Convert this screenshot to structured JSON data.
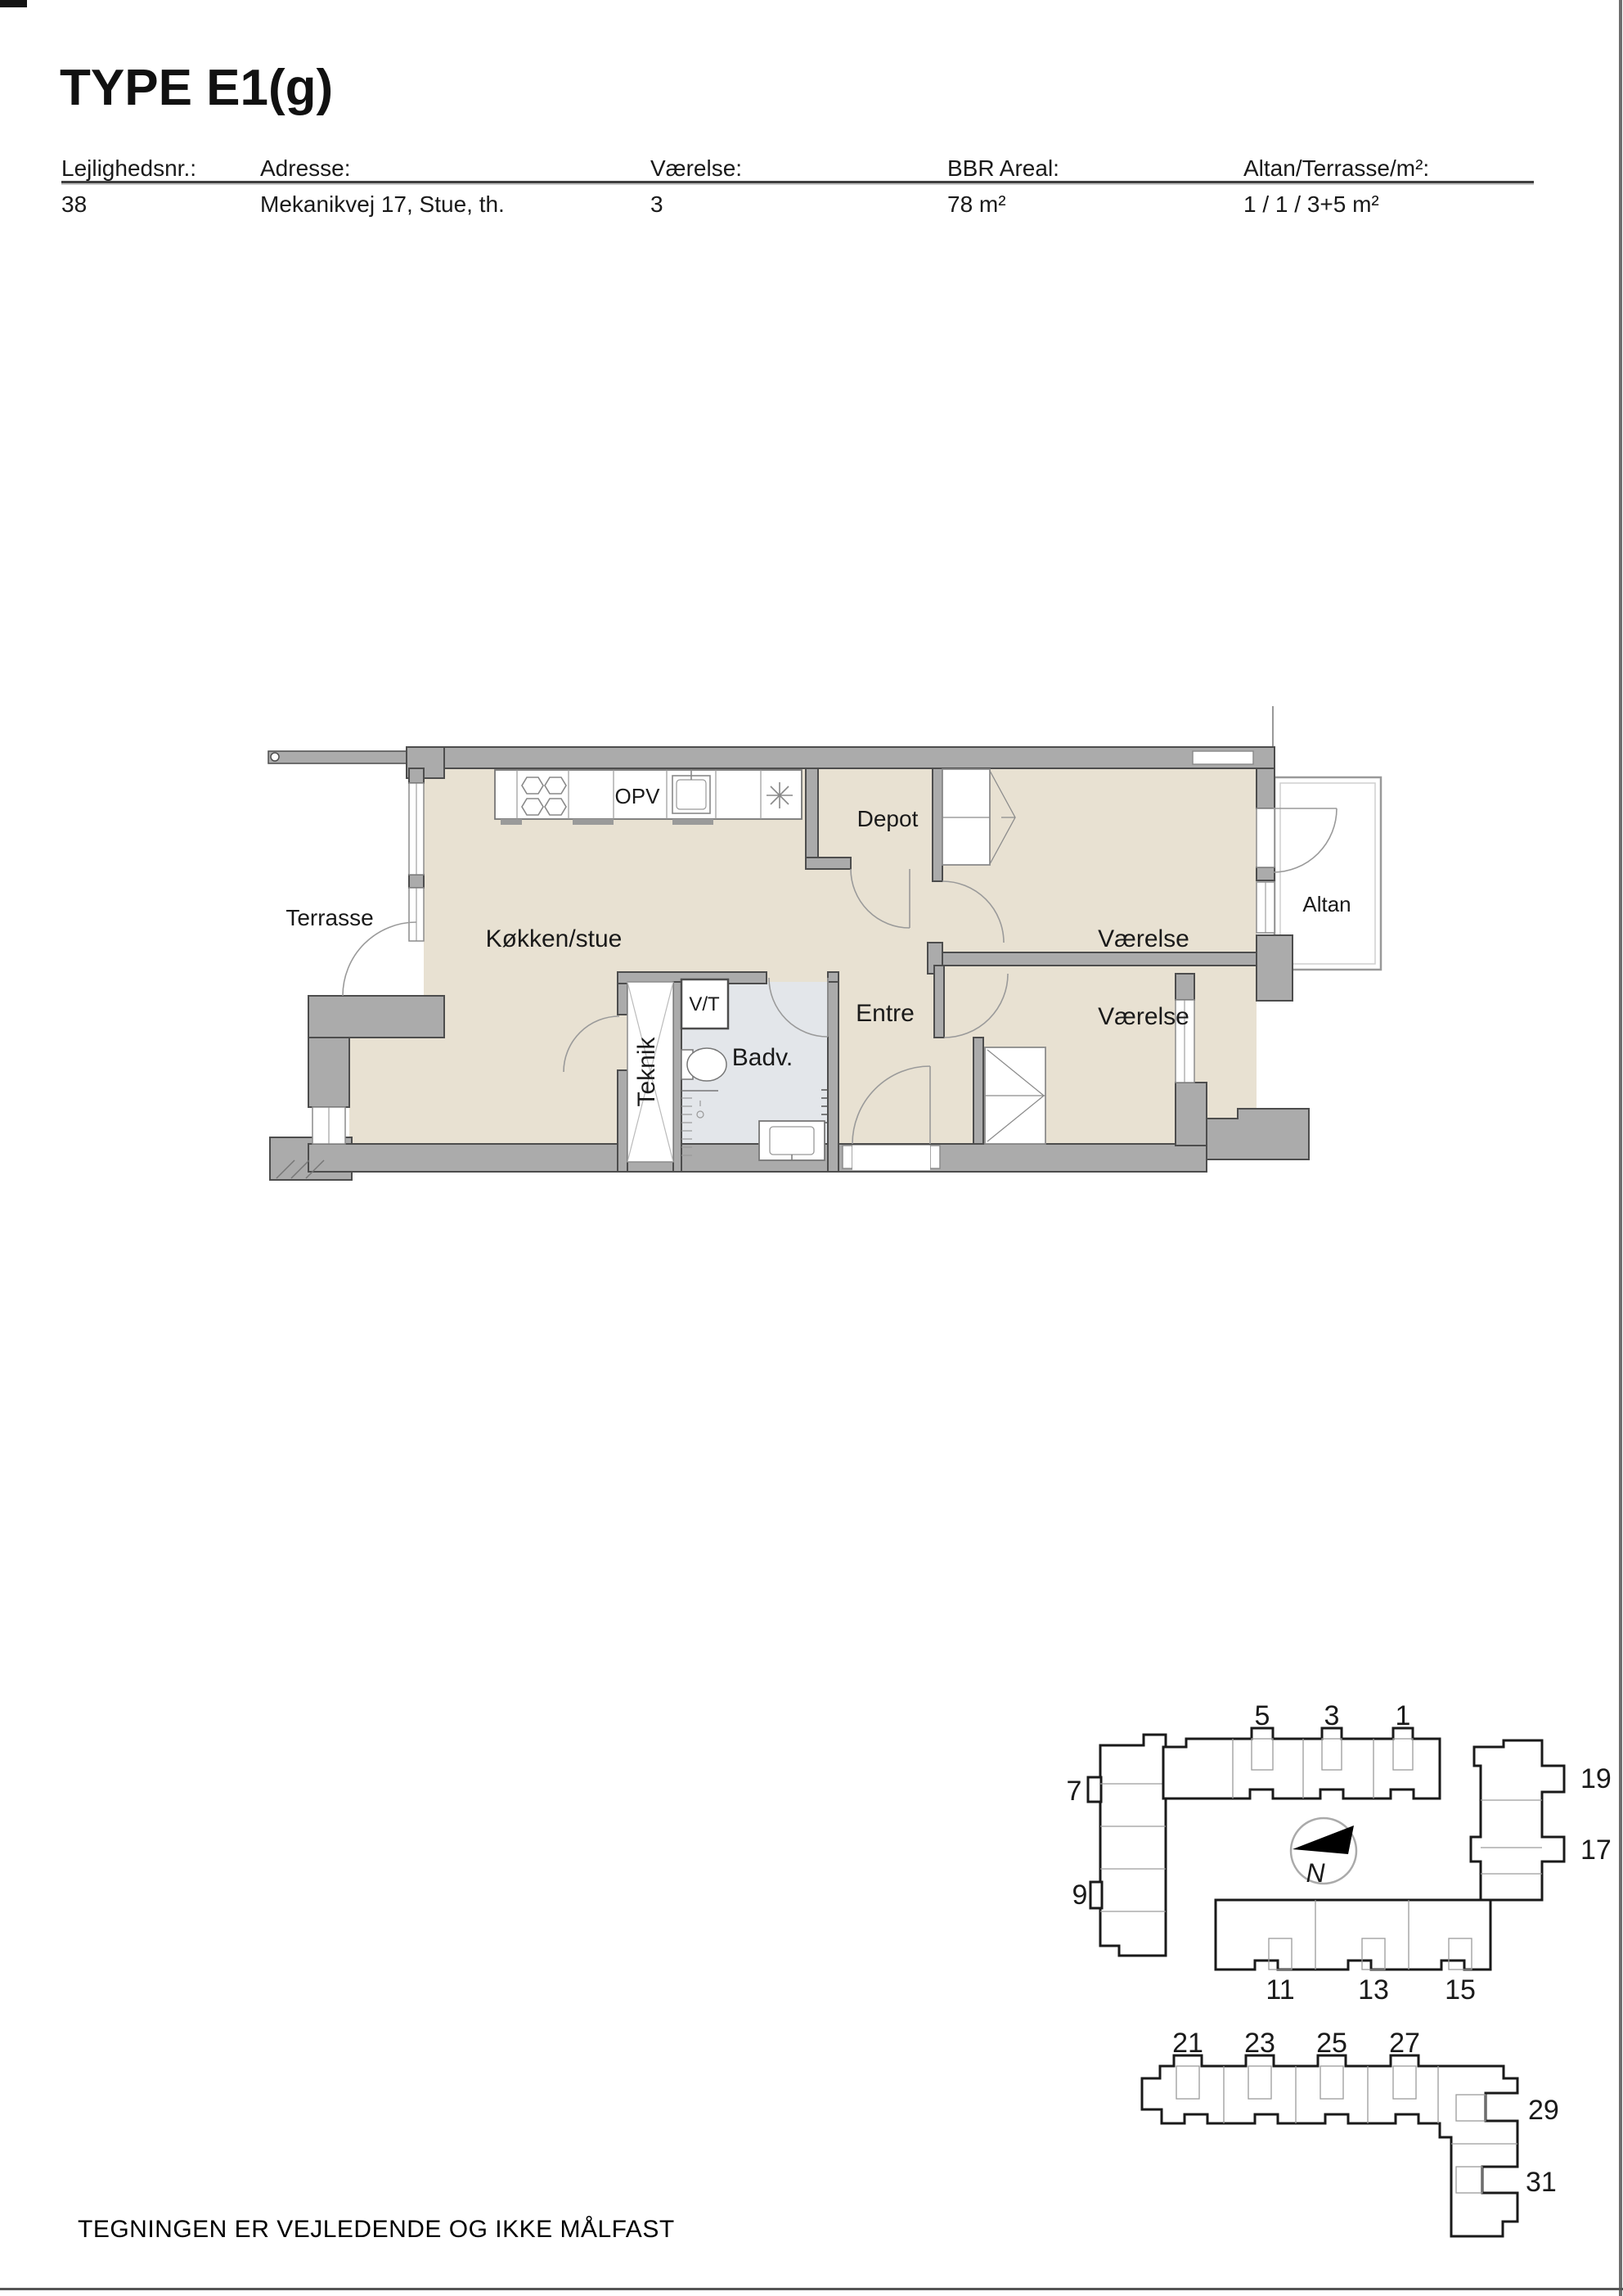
{
  "page": {
    "title": "TYPE E1(g)",
    "footer_note": "TEGNINGEN ER VEJLEDENDE OG IKKE MÅLFAST"
  },
  "info_table": {
    "columns": [
      {
        "label": "Lejlighedsnr.:",
        "value": "38"
      },
      {
        "label": "Adresse:",
        "value": "Mekanikvej 17, Stue, th."
      },
      {
        "label": "Værelse:",
        "value": "3"
      },
      {
        "label": "BBR Areal:",
        "value": "78 m²"
      },
      {
        "label": "Altan/Terrasse/m²:",
        "value": "1 / 1 / 3+5 m²"
      }
    ]
  },
  "floor_plan": {
    "rooms": {
      "kitchen_living": "Køkken/stue",
      "depot": "Depot",
      "bedroom_upper": "Værelse",
      "bedroom_lower": "Værelse",
      "entry": "Entre",
      "bathroom": "Badv.",
      "tech": "Teknik",
      "vt": "V/T",
      "dishwasher": "OPV",
      "terrace": "Terrasse",
      "balcony": "Altan"
    }
  },
  "site_plans": {
    "upper": {
      "labels_top": [
        "5",
        "3",
        "1"
      ],
      "labels_left": [
        "7",
        "9"
      ],
      "labels_right": [
        "19",
        "17"
      ],
      "labels_bottom": [
        "11",
        "13",
        "15"
      ],
      "compass": "N"
    },
    "lower": {
      "labels_top": [
        "21",
        "23",
        "25",
        "27"
      ],
      "labels_right": [
        "29",
        "31"
      ]
    }
  },
  "colors": {
    "floor": "#e8e1d2",
    "bath_floor": "#e3e6ea",
    "wall_fill": "#ababab",
    "wall_edge": "#4d4d4d",
    "thin_line": "#8c8c8c",
    "site_outline": "#1a1a1a"
  }
}
